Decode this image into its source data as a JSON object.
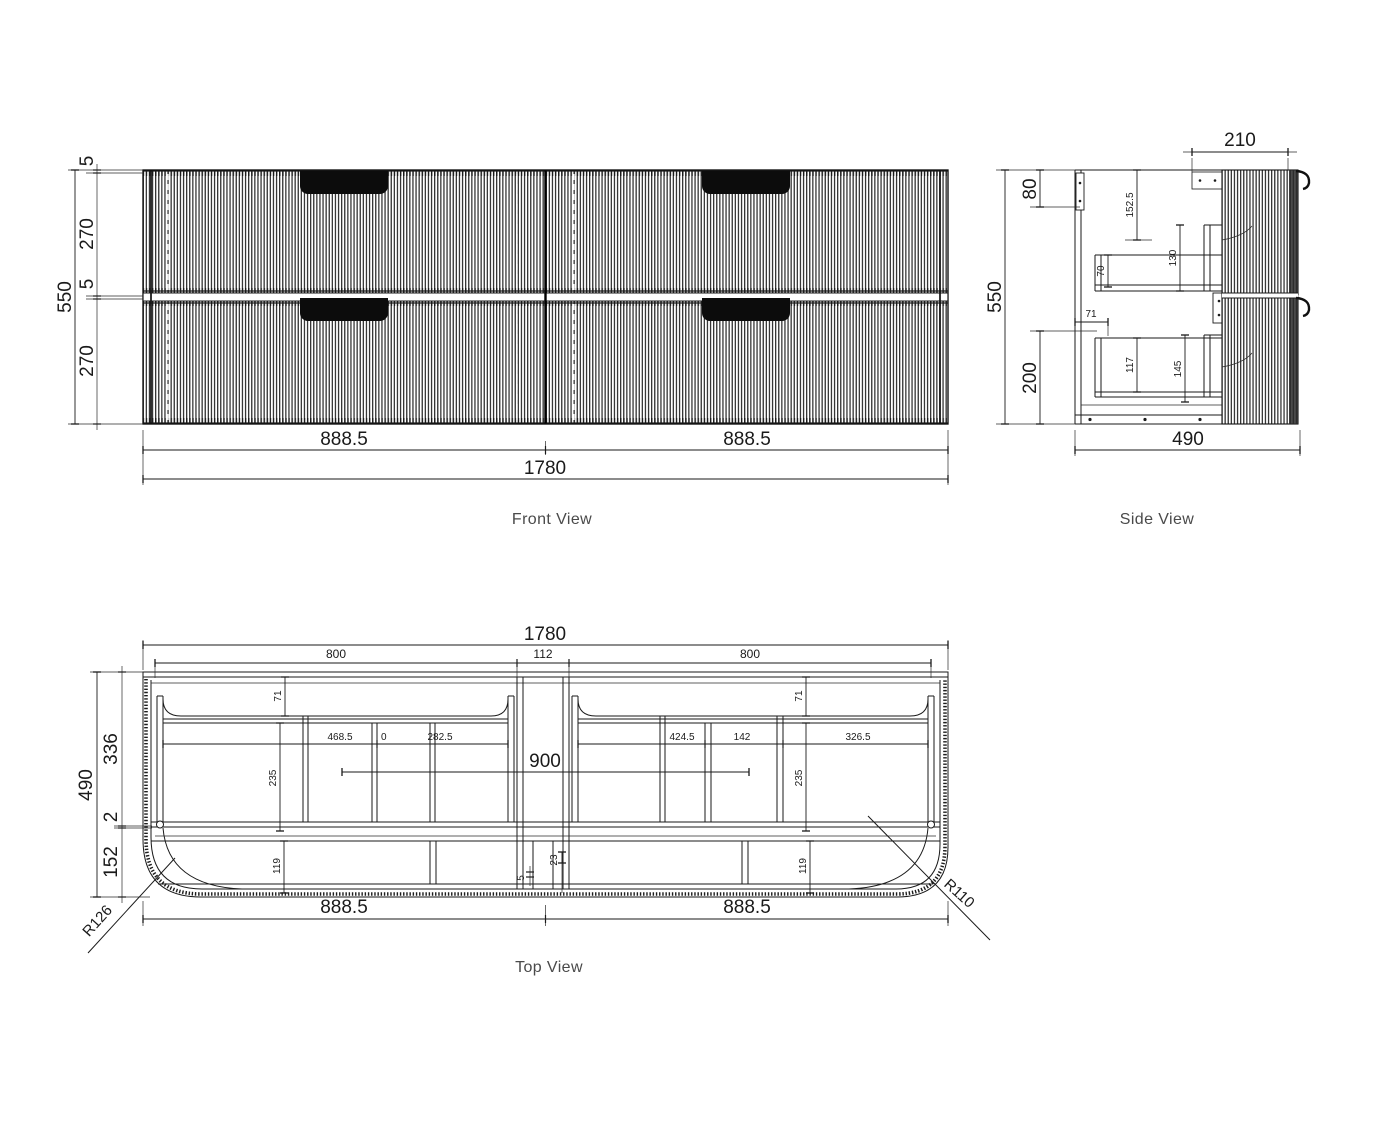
{
  "colors": {
    "background": "#ffffff",
    "ink": "#1a1a1a",
    "muted_label": "#4a4a4a",
    "handle_fill": "#0c0c0c"
  },
  "views": {
    "front": {
      "label": "Front View",
      "dims": {
        "overall_width": "1780",
        "half_width_left": "888.5",
        "half_width_right": "888.5",
        "overall_height": "550",
        "top_gap": "5",
        "top_drawer_height": "270",
        "mid_gap": "5",
        "bottom_drawer_height": "270"
      }
    },
    "side": {
      "label": "Side View",
      "dims": {
        "overall_height": "550",
        "wall_rail_height": "80",
        "bottom_section_height": "200",
        "overall_depth": "490",
        "top_inset_depth": "210",
        "runner_drop": "152.5",
        "top_drawer_back_height": "70",
        "top_drawer_front_height": "130",
        "base_offset": "71",
        "bottom_drawer_back_height": "117",
        "bottom_drawer_front_height": "145"
      }
    },
    "top": {
      "label": "Top View",
      "dims": {
        "overall_width": "1780",
        "opening_left": "800",
        "center_gap": "112",
        "opening_right": "800",
        "overall_depth": "490",
        "back_section": "336",
        "rail_thickness": "2",
        "front_section": "152",
        "back_gap_left": "71",
        "back_gap_right": "71",
        "left_span_a": "468.5",
        "left_span_b": "0",
        "left_span_c": "282.5",
        "right_span_a": "424.5",
        "right_span_b": "142",
        "right_span_c": "326.5",
        "drawer_depth_left": "235",
        "drawer_depth_right": "235",
        "basin_cutout_width": "900",
        "front_depth_left": "119",
        "front_depth_right": "119",
        "front_small_a": "23",
        "front_small_b": "5",
        "half_width_left": "888.5",
        "half_width_right": "888.5",
        "corner_radius_left": "R126",
        "corner_radius_right": "R110"
      }
    }
  }
}
